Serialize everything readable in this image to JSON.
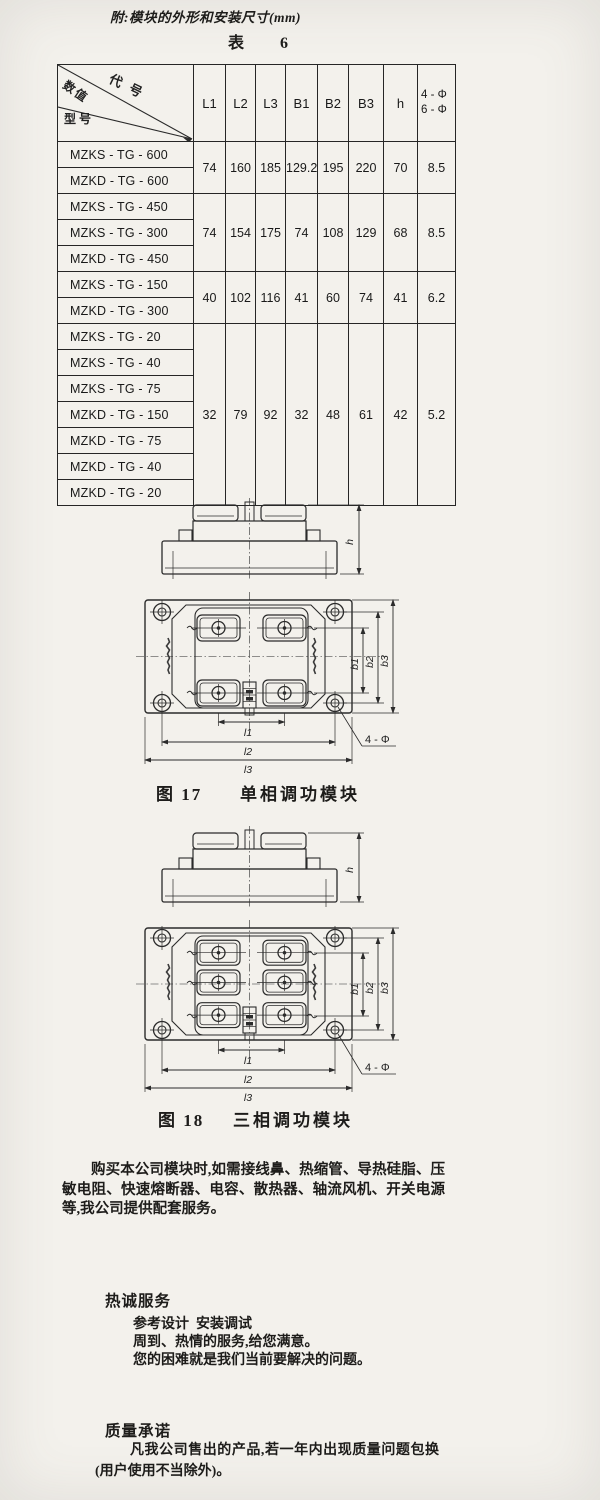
{
  "page": {
    "title": "附:模块的外形和安装尺寸(mm)",
    "table_caption": "表  6"
  },
  "table": {
    "corner": {
      "code": "代号",
      "value": "数值",
      "model": "型号"
    },
    "columns": [
      "L1",
      "L2",
      "L3",
      "B1",
      "B2",
      "B3",
      "h"
    ],
    "phi_column": [
      "4 - Φ",
      "6 - Φ"
    ],
    "groups": [
      {
        "models": [
          "MZKS - TG - 600",
          "MZKD - TG - 600"
        ],
        "values": [
          "74",
          "160",
          "185",
          "129.2",
          "195",
          "220",
          "70",
          "8.5"
        ]
      },
      {
        "models": [
          "MZKS - TG - 450",
          "MZKS - TG - 300",
          "MZKD - TG - 450"
        ],
        "values": [
          "74",
          "154",
          "175",
          "74",
          "108",
          "129",
          "68",
          "8.5"
        ]
      },
      {
        "models": [
          "MZKS - TG - 150",
          "MZKD - TG - 300"
        ],
        "values": [
          "40",
          "102",
          "116",
          "41",
          "60",
          "74",
          "41",
          "6.2"
        ]
      },
      {
        "models": [
          "MZKS - TG - 20",
          "MZKS - TG - 40",
          "MZKS - TG - 75",
          "MZKD - TG - 150",
          "MZKD - TG - 75",
          "MZKD - TG - 40",
          "MZKD - TG - 20"
        ],
        "values": [
          "32",
          "79",
          "92",
          "32",
          "48",
          "61",
          "42",
          "5.2"
        ]
      }
    ]
  },
  "figures": {
    "dim_labels": {
      "h": "h",
      "b1": "b1",
      "b2": "b2",
      "b3": "b3",
      "l1": "l1",
      "l2": "l2",
      "l3": "l3",
      "holes": "4 - Φ"
    },
    "items": [
      {
        "number": "图 17",
        "title": "单相调功模块"
      },
      {
        "number": "图 18",
        "title": "三相调功模块"
      }
    ]
  },
  "paragraphs": {
    "accessories": "购买本公司模块时,如需接线鼻、热缩管、导热硅脂、压敏电阻、快速熔断器、电容、散热器、轴流风机、开关电源等,我公司提供配套服务。",
    "service": {
      "heading": "热诚服务",
      "lines": [
        "参考设计  安装调试",
        "周到、热情的服务,给您满意。",
        "您的困难就是我们当前要解决的问题。"
      ]
    },
    "quality": {
      "heading": "质量承诺",
      "text": "凡我公司售出的产品,若一年内出现质量问题包换(用户使用不当除外)。"
    }
  }
}
